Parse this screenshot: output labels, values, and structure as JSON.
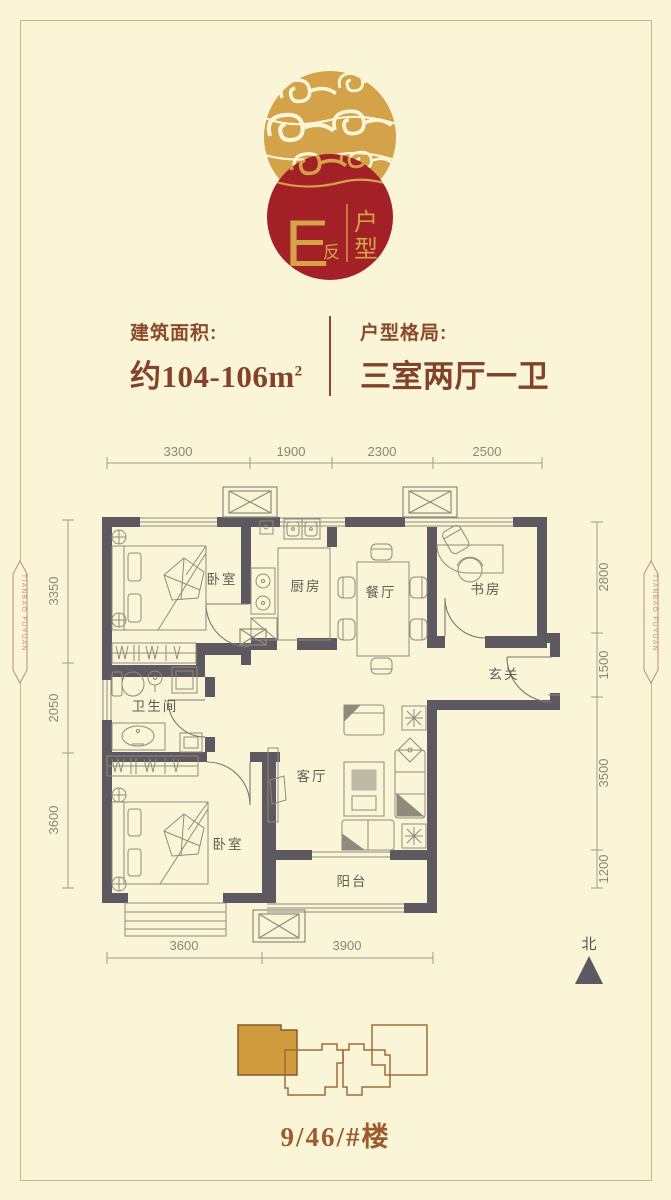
{
  "page": {
    "bg": "#FBF5D8",
    "border_color": "#C9B48C"
  },
  "logo": {
    "letter": "E",
    "letter_suffix": "反",
    "chars": [
      "户",
      "型"
    ],
    "red": "#A32126",
    "gold": "#D4A249"
  },
  "info": {
    "area_label": "建筑面积:",
    "area_value": "约104-106m",
    "area_superscript": "2",
    "layout_label": "户型格局:",
    "layout_value": "三室两厅一卫"
  },
  "floorplan": {
    "wall_color": "#5C5A60",
    "rooms": [
      {
        "id": "bedroom-top",
        "label": "卧室"
      },
      {
        "id": "kitchen",
        "label": "厨房"
      },
      {
        "id": "dining",
        "label": "餐厅"
      },
      {
        "id": "study",
        "label": "书房"
      },
      {
        "id": "entry",
        "label": "玄关"
      },
      {
        "id": "bathroom",
        "label": "卫生间"
      },
      {
        "id": "living",
        "label": "客厅"
      },
      {
        "id": "bedroom-bottom",
        "label": "卧室"
      },
      {
        "id": "balcony",
        "label": "阳台"
      }
    ],
    "dimensions_top": [
      "3300",
      "1900",
      "2300",
      "2500"
    ],
    "dimensions_left": [
      "3350",
      "2050",
      "3600"
    ],
    "dimensions_right": [
      "2800",
      "1500",
      "3500",
      "1200"
    ],
    "dimensions_bottom": [
      "3600",
      "3900"
    ],
    "north_label": "北"
  },
  "site_plan": {
    "label": "9/46/#楼",
    "highlight_color": "#D09B3C"
  },
  "side_badges": {
    "text": "TIANBAO FUYUAN"
  }
}
